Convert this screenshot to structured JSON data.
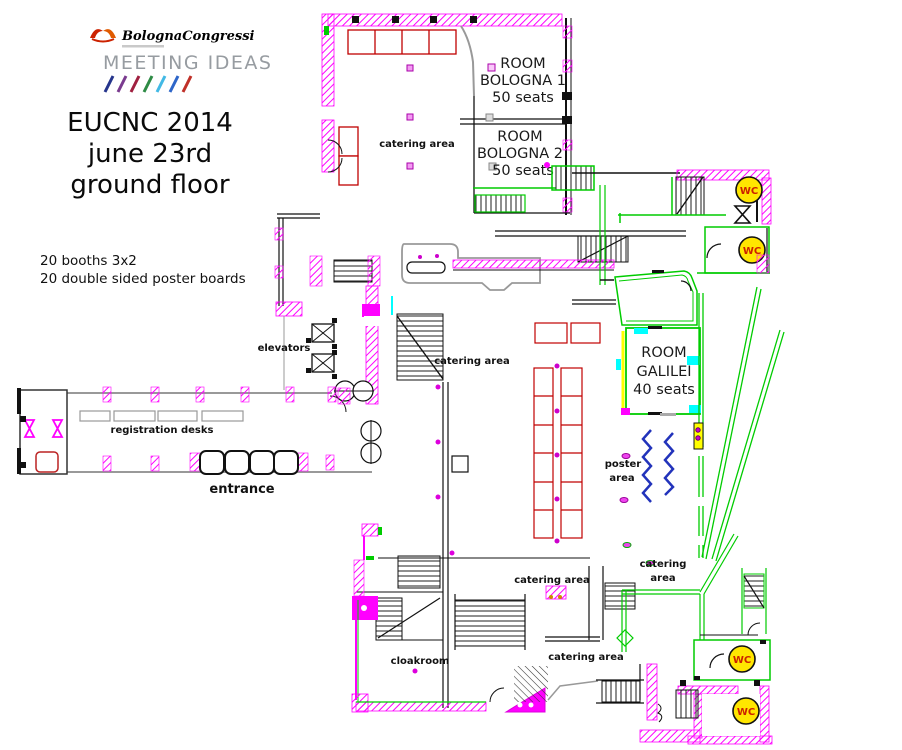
{
  "branding": {
    "logo_text": "BolognaCongressi",
    "tagline": "MEETING IDEAS"
  },
  "header": {
    "title_lines": [
      "EUCNC 2014",
      "june 23rd",
      "ground floor"
    ],
    "notes": [
      "20 booths 3x2",
      "20 double sided poster boards"
    ]
  },
  "rooms": {
    "bologna1": {
      "line1": "ROOM",
      "line2": "BOLOGNA 1",
      "capacity": "50 seats"
    },
    "bologna2": {
      "line1": "ROOM",
      "line2": "BOLOGNA 2",
      "capacity": "50 seats"
    },
    "galilei": {
      "line1": "ROOM",
      "line2": "GALILEI",
      "capacity": "40 seats"
    }
  },
  "labels": {
    "catering_area": "catering area",
    "catering": "catering",
    "area": "area",
    "poster": "poster",
    "cloakroom": "cloakroom",
    "elevators": "elevators",
    "registration_desks": "registration desks",
    "entrance": "entrance",
    "wc": "WC"
  },
  "colors": {
    "wall_magenta": "#ff00ff",
    "partition_green": "#00cc00",
    "furniture_red": "#c00000",
    "poster_blue": "#2233bb",
    "wc_fill": "#ffe600",
    "wc_text": "#cc2200",
    "accent_cyan": "#00ffff",
    "accent_yellow": "#ffff00"
  }
}
